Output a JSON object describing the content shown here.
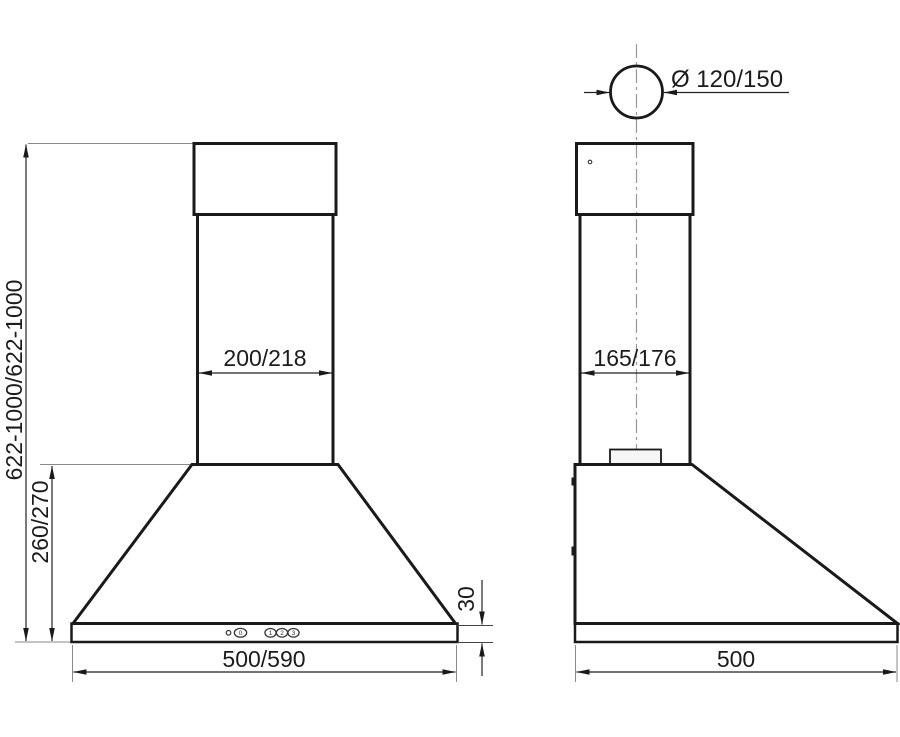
{
  "drawing": {
    "type": "cooker-hood-installation-dimension-drawing",
    "dims": {
      "overall_height": "622-1000/622-1000",
      "hood_body_height": "260/270",
      "chimney_width_front": "200/218",
      "chimney_depth_side": "165/176",
      "base_strip_height": "30",
      "hood_width_front": "500/590",
      "hood_depth_side": "500",
      "outlet_diameter": "Ø 120/150"
    },
    "controls": {
      "off_button": "0",
      "speed_1_button": "1",
      "speed_2_button": "2",
      "speed_3_button": "3"
    },
    "colors": {
      "outline": "#1a1a1a",
      "dimension_line": "#222222",
      "extension_line": "#8a8a8a",
      "centerline": "#999999",
      "fill_light": "#f6f6f6",
      "fill_shade": "#dcdcdc",
      "background": "#ffffff"
    }
  }
}
